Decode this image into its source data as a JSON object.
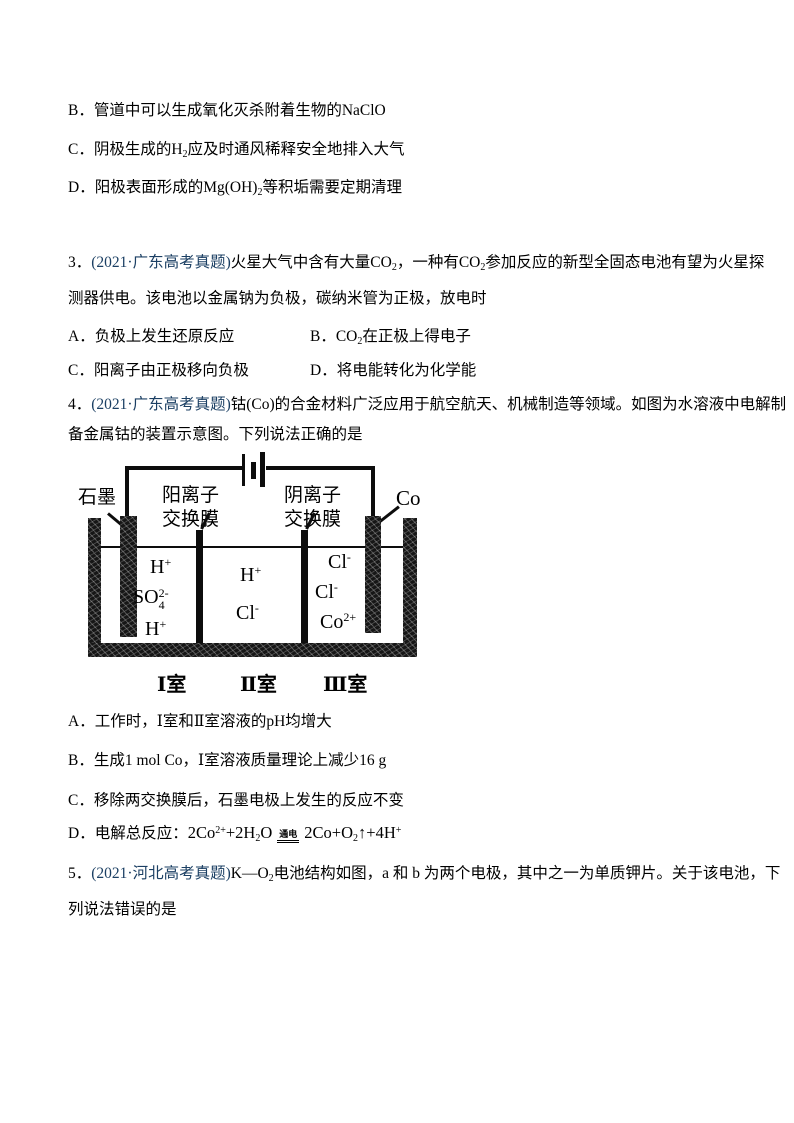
{
  "page": {
    "background": "#ffffff",
    "text_color": "#000000",
    "cite_color": "#1b3f63"
  },
  "q2_options": {
    "b": "B．管道中可以生成氧化灭杀附着生物的NaClO",
    "c": {
      "pre": "C．阴极生成的H",
      "sub": "2",
      "post": "应及时通风稀释安全地排入大气"
    },
    "d": {
      "pre": "D．阳极表面形成的Mg(OH)",
      "sub": "2",
      "post": "等积垢需要定期清理"
    }
  },
  "q3": {
    "number": "3．",
    "cite": "(2021·广东高考真题)",
    "stem1a": "火星大气中含有大量CO",
    "stem1a_sub": "2",
    "stem1b": "，一种有CO",
    "stem1b_sub": "2",
    "stem1c": "参加反应的新型全固态电池有望为火星探",
    "stem2": "测器供电。该电池以金属钠为负极，碳纳米管为正极，放电时",
    "opt_a": "A．负极上发生还原反应",
    "opt_b_pre": "B．CO",
    "opt_b_sub": "2",
    "opt_b_post": "在正极上得电子",
    "opt_c": "C．阳离子由正极移向负极",
    "opt_d": "D．将电能转化为化学能"
  },
  "q4": {
    "number": "4．",
    "cite": "(2021·广东高考真题)",
    "stem1": "钴(Co)的合金材料广泛应用于航空航天、机械制造等领域。如图为水溶液中电解制",
    "stem2": "备金属钴的装置示意图。下列说法正确的是",
    "diagram": {
      "graphite_label": "石墨",
      "cation_membrane_line1": "阳离子",
      "cation_membrane_line2": "交换膜",
      "anion_membrane_line1": "阴离子",
      "anion_membrane_line2": "交换膜",
      "cobalt_label": "Co",
      "c1_ion1": "H",
      "c1_ion1_sup": "+",
      "c1_ion2": "SO",
      "c1_ion2_sup": "2-",
      "c1_ion2_sub": "4",
      "c1_ion3": "H",
      "c1_ion3_sup": "+",
      "c2_ion1": "H",
      "c2_ion1_sup": "+",
      "c2_ion2": "Cl",
      "c2_ion2_sup": "-",
      "c3_ion1": "Cl",
      "c3_ion1_sup": "-",
      "c3_ion2": "Cl",
      "c3_ion2_sup": "-",
      "c3_ion3": "Co",
      "c3_ion3_sup": "2+",
      "room1": "Ⅰ室",
      "room2": "Ⅱ室",
      "room3": "Ⅲ室"
    },
    "opt_a": "A．工作时，Ⅰ室和Ⅱ室溶液的pH均增大",
    "opt_b": "B．生成1 mol Co，Ⅰ室溶液质量理论上减少16 g",
    "opt_c": "C．移除两交换膜后，石墨电极上发生的反应不变",
    "opt_d_label": "D．电解总反应：",
    "eq": {
      "p1": "2Co",
      "sup1": "2+",
      "p2": "+2H",
      "sub1": "2",
      "p3": "O",
      "cond": "通电",
      "p4": "2Co+O",
      "sub2": "2",
      "p5": "↑+4H",
      "sup2": "+"
    }
  },
  "q5": {
    "number": "5．",
    "cite": "(2021·河北高考真题)",
    "stem1a": "K—O",
    "stem1a_sub": "2",
    "stem1b": "电池结构如图，a 和 b 为两个电极，其中之一为单质钾片。关于该电池，下",
    "stem2": "列说法错误的是"
  }
}
